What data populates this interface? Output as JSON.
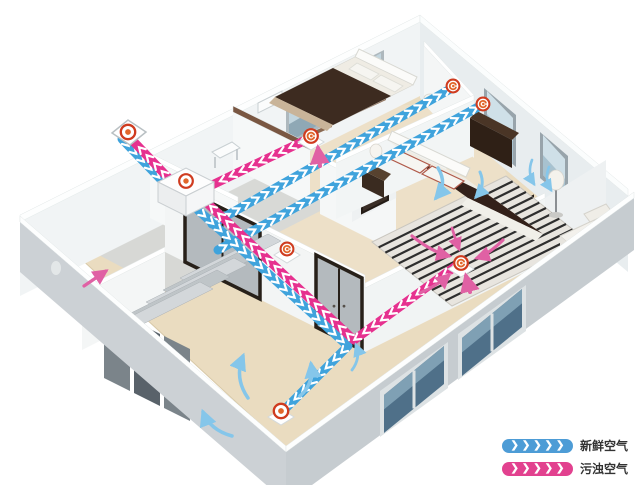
{
  "legend": {
    "chevrons": "❯❯❯❯❯",
    "items": [
      {
        "id": "fresh-air",
        "label": "新鲜空气",
        "color": "#4d9cd6"
      },
      {
        "id": "exhaust-air",
        "label": "污浊空气",
        "color": "#e2418f"
      }
    ]
  },
  "colors": {
    "fresh_air_duct": "#3fa3dc",
    "exhaust_air_duct": "#e6318f",
    "room_airflow_blue": "#85c6ea",
    "room_airflow_pink": "#e061a4",
    "vent_ring": "#cf3b1f",
    "vent_center": "#e1662a",
    "floor_wood": "#eadcc0",
    "wall_inner": "#f2f5f5",
    "wall_outer": "#ccd1d5",
    "dark_wood": "#34241b"
  },
  "vents": [
    {
      "id": "outdoor-intake-exhaust-vent",
      "type": "target"
    },
    {
      "id": "heat-recovery-unit-vent",
      "type": "target"
    },
    {
      "id": "bulkhead-exhaust-vent",
      "type": "swirl"
    },
    {
      "id": "bedroom1-supply-vent",
      "type": "swirl"
    },
    {
      "id": "bedroom2-supply-vent",
      "type": "swirl"
    },
    {
      "id": "hallway-exhaust-vent",
      "type": "swirl"
    },
    {
      "id": "bedroom2-return-vent",
      "type": "swirl"
    },
    {
      "id": "livingroom-supply-vent",
      "type": "target"
    }
  ]
}
